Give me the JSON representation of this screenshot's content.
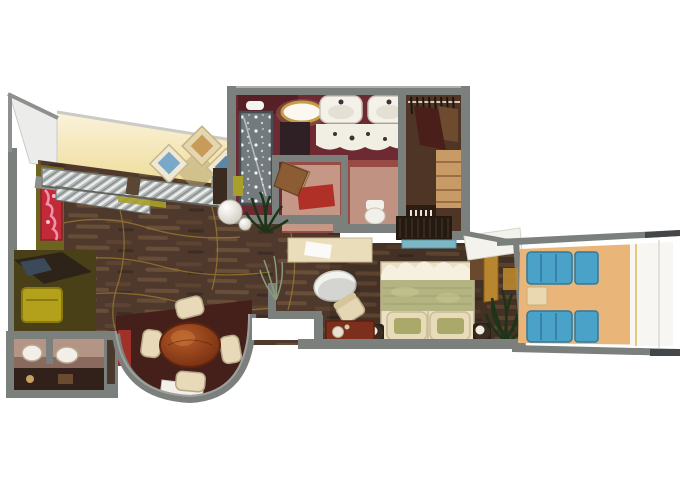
{
  "meta": {
    "type": "floorplan-render",
    "description": "3D top-down floor plan of a cruise-ship suite with living room, dining bay, bathroom, walk-in closet, bedroom and private balcony",
    "width_px": 680,
    "height_px": 486
  },
  "palette": {
    "bg": "#ffffff",
    "wall": "#7c807c",
    "wallDark": "#585c58",
    "wallLight": "#aeb1ae",
    "wood": "#4e392c",
    "goldLine": "#a8862e",
    "yellowWall": "#f0df9c",
    "creamWall": "#faf3dd",
    "oliveWall": "#6e6420",
    "oliveFloor": "#4a4018",
    "artRed": "#c22a3a",
    "sofaGray": "#b3b8b6",
    "bayFloor": "#45201a",
    "bayRed": "#a03028",
    "tableWood": "#8f3c1a",
    "chairCream": "#e8d9b8",
    "deskDark": "#2e2318",
    "chairYellow": "#b3a11c",
    "guestBathWall": "#b89a8a",
    "guestBathFloor": "#8a6a5e",
    "bathMaroon": "#6e2a32",
    "bathMaroonDark": "#571f26",
    "bathFloorRed": "#a05048",
    "wcPink": "#caa08e",
    "matRed": "#b03028",
    "vanityWhite": "#f1eee4",
    "closetBrown": "#4e3526",
    "shelfTan": "#c89a66",
    "blueGlass": "#7fb6c4",
    "bedCream": "#ece0c4",
    "bedWhite": "#f6f0e0",
    "bedSage": "#b4b482",
    "pillowSage": "#aaa969",
    "cabinetRed": "#7c2f1c",
    "doorGold": "#b8862e",
    "curtain": "#f4f2ec",
    "plantDark": "#1c3418",
    "plantSoft": "#8a9a7a",
    "balconyTan": "#eab579",
    "deckWhite": "#f7f6f2",
    "deckTrim": "#e0ca80",
    "lounger": "#4aa2c8",
    "loungerDark": "#2e7a9c",
    "sideTable": "#ead9b0",
    "lampWhite": "#f3f1e9",
    "doorBrown": "#8a5a32"
  },
  "rooms": [
    {
      "id": "living-room",
      "name": "Living Room",
      "furniture": [
        "striped sofa",
        "red wall art",
        "diamond picture frames",
        "ball floor lamp",
        "dark side shelf",
        "gold-accent wood floor"
      ]
    },
    {
      "id": "desk-nook",
      "name": "Desk Nook",
      "furniture": [
        "dark desk",
        "yellow chair"
      ]
    },
    {
      "id": "guest-bathroom",
      "name": "Guest Bathroom",
      "furniture": [
        "twin round sinks"
      ]
    },
    {
      "id": "dining-bay",
      "name": "Dining Bay Window",
      "furniture": [
        "oval wood table",
        "four cream chairs",
        "entry mat"
      ]
    },
    {
      "id": "master-bathroom",
      "name": "Master Bathroom",
      "furniture": [
        "glass shower",
        "oval ceiling light",
        "double sinks",
        "wavy vanity counter",
        "water closet with red mat",
        "toilet",
        "swing door"
      ]
    },
    {
      "id": "walk-in-closet",
      "name": "Walk-in Closet",
      "furniture": [
        "hanging rails with clothes",
        "tan shelves",
        "blue-glass console"
      ]
    },
    {
      "id": "bedroom",
      "name": "Bedroom",
      "furniture": [
        "queen bed with sage runner",
        "two ball lamps",
        "white oval side table",
        "cream armchair",
        "red cabinet",
        "gold door frame",
        "potted plant",
        "white curtain",
        "writing desk"
      ]
    },
    {
      "id": "balcony",
      "name": "Private Balcony",
      "furniture": [
        "two blue loungers",
        "cream side table",
        "white deck edge",
        "gray railings"
      ]
    }
  ]
}
